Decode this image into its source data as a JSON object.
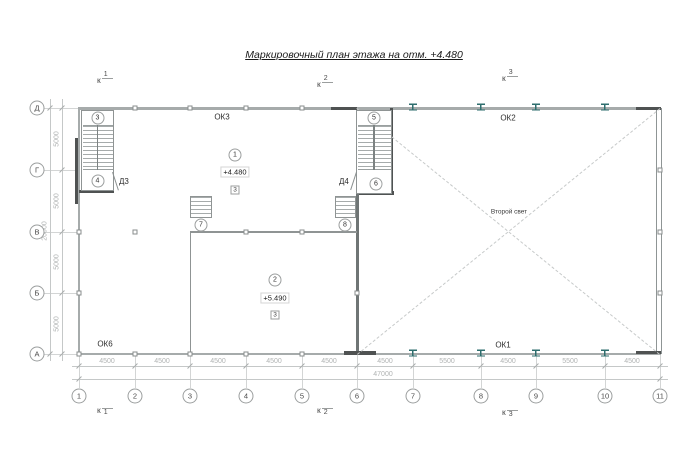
{
  "title": "Маркировочный план этажа на отм. +4.480",
  "section_markers": {
    "k": "к",
    "top": [
      "1",
      "2",
      "3"
    ],
    "bottom": [
      "1",
      "2",
      "3"
    ]
  },
  "axes": {
    "columns": [
      "1",
      "2",
      "3",
      "4",
      "5",
      "6",
      "7",
      "8",
      "9",
      "10",
      "11"
    ],
    "rows": [
      "Д",
      "Г",
      "В",
      "Б",
      "А"
    ]
  },
  "dims": {
    "bottom": [
      "4500",
      "4500",
      "4500",
      "4500",
      "4500",
      "4500",
      "5500",
      "4500",
      "5500",
      "4500"
    ],
    "bottom_total": "47000",
    "left": [
      "5000",
      "5000",
      "5000",
      "5000"
    ],
    "left_total": "20000"
  },
  "labels": {
    "ok3": "ОК3",
    "ok2": "ОК2",
    "ok6": "ОК6",
    "ok1": "ОК1",
    "void": "Второй свет",
    "d3": "Д3",
    "d4": "Д4"
  },
  "zones": {
    "zone1": {
      "num": "1",
      "elev": "+4.480",
      "type": "3"
    },
    "zone2": {
      "num": "2",
      "elev": "+5.490",
      "type": "3"
    }
  },
  "stairs": {
    "s3": "3",
    "s4": "4",
    "s5": "5",
    "s6": "6",
    "s7": "7",
    "s8": "8"
  },
  "colors": {
    "wall_light": "#a6abab",
    "wall_dark": "#4f5252",
    "steel_column": "#2e6e6e",
    "dim_text": "#b0b3b3"
  }
}
